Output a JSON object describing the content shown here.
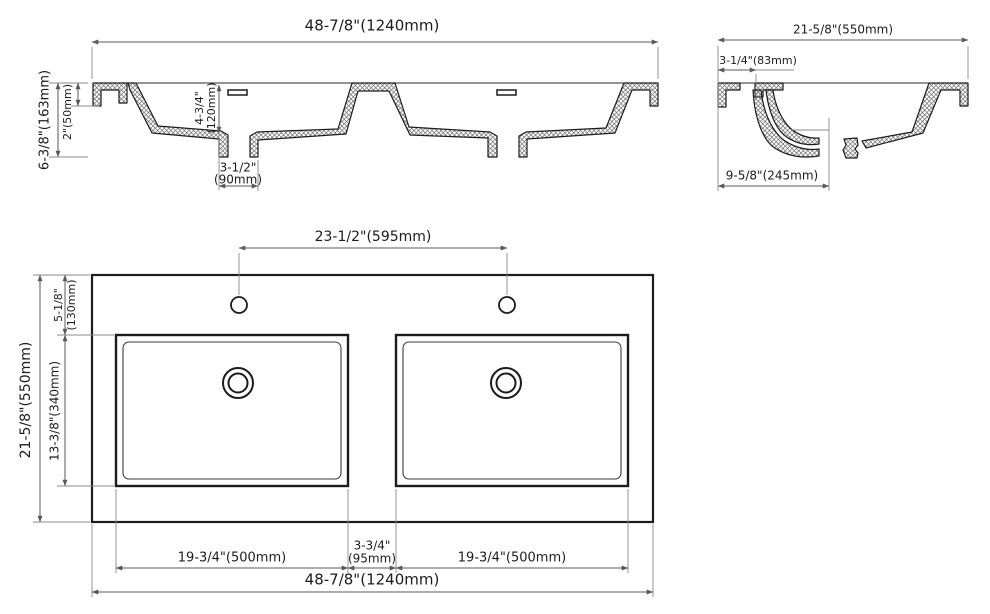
{
  "front_view": {
    "width_label": "48-7/8\"(1240mm)",
    "height_label": "6-3/8\"(163mm)",
    "rim_label": "2\"(50mm)",
    "bowl_depth_line1": "4-3/4\"",
    "bowl_depth_line2": "(120mm)",
    "drain_width_line1": "3-1/2\"",
    "drain_width_line2": "(90mm)"
  },
  "side_view": {
    "depth_label": "21-5/8\"(550mm)",
    "back_ledge_label": "3-1/4\"(83mm)",
    "drain_offset_label": "9-5/8\"(245mm)"
  },
  "plan_view": {
    "faucet_spacing_label": "23-1/2\"(595mm)",
    "front_ledge_line1": "5-1/8\"",
    "front_ledge_line2": "(130mm)",
    "bowl_front_back_label": "13-3/8\"(340mm)",
    "overall_depth_label": "21-5/8\"(550mm)",
    "left_bowl_width_label": "19-3/4\"(500mm)",
    "center_gap_line1": "3-3/4\"",
    "center_gap_line2": "(95mm)",
    "right_bowl_width_label": "19-3/4\"(500mm)",
    "overall_width_label": "48-7/8\"(1240mm)"
  },
  "colors": {
    "line": "#1c1c1c",
    "dim_line": "#5a5a5a",
    "background": "#ffffff"
  }
}
